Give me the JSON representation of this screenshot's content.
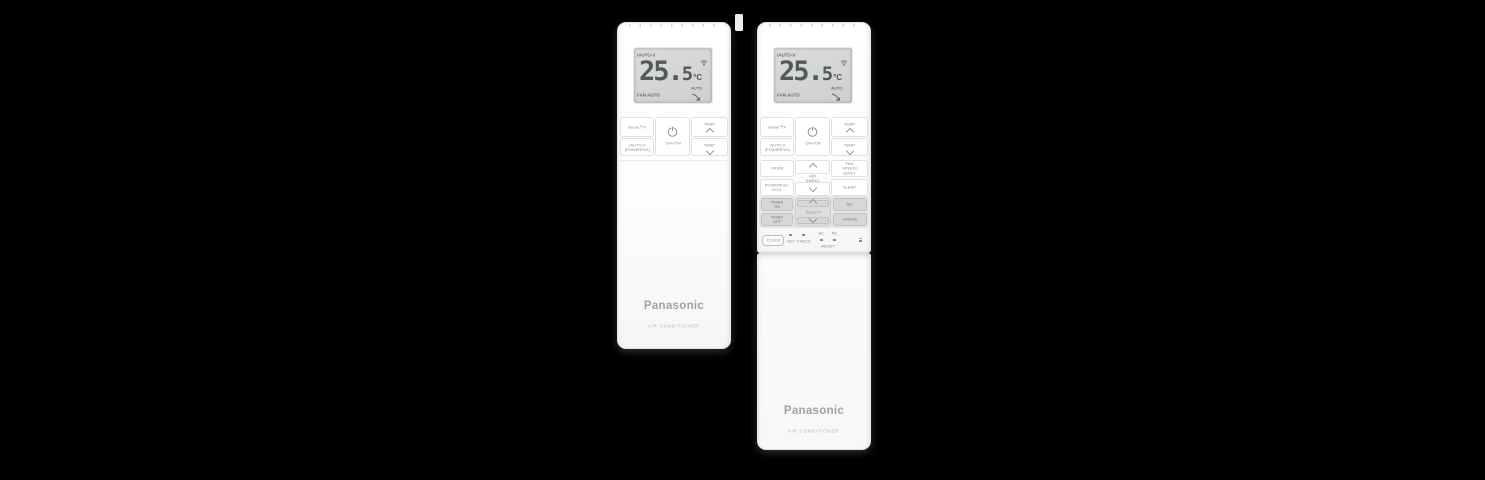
{
  "scene": {
    "background_color": "#000000"
  },
  "display": {
    "mode": "iAUTO-X",
    "temp_int": "25.",
    "temp_dec": "5",
    "unit": "°C",
    "fan_status": "FAN AUTO",
    "swing_status": "AUTO"
  },
  "icons": {
    "wifi": "wifi-signal",
    "power": "power-circle",
    "temp_up": "chevron-up",
    "temp_down": "chevron-down",
    "fan_swing": "auto-fan-swing"
  },
  "buttons": {
    "nanoe": "nanoe™X",
    "iauto_x": "iAUTO-X\n(POWERFUL)",
    "power": "OFF/ON",
    "temp": "TEMP",
    "mode": "MODE",
    "air_swing": "AIR SWING",
    "fan_speed": "FAN SPEED/\nQUIET",
    "powerful_eco": "POWERFUL/\nECO",
    "sleep": "SLEEP",
    "timer_on": "TIMER\nON",
    "timer_off": "TIMER\nOFF",
    "select": "SELECT",
    "set": "SET",
    "cancel": "CANCEL",
    "clock": "CLOCK"
  },
  "pinholes": {
    "set": "SET",
    "check": "CHECK",
    "ac": "AC",
    "rc": "RC",
    "reset": "RESET"
  },
  "branding": {
    "logo": "Panasonic",
    "tagline": "AIR CONDITIONER"
  }
}
